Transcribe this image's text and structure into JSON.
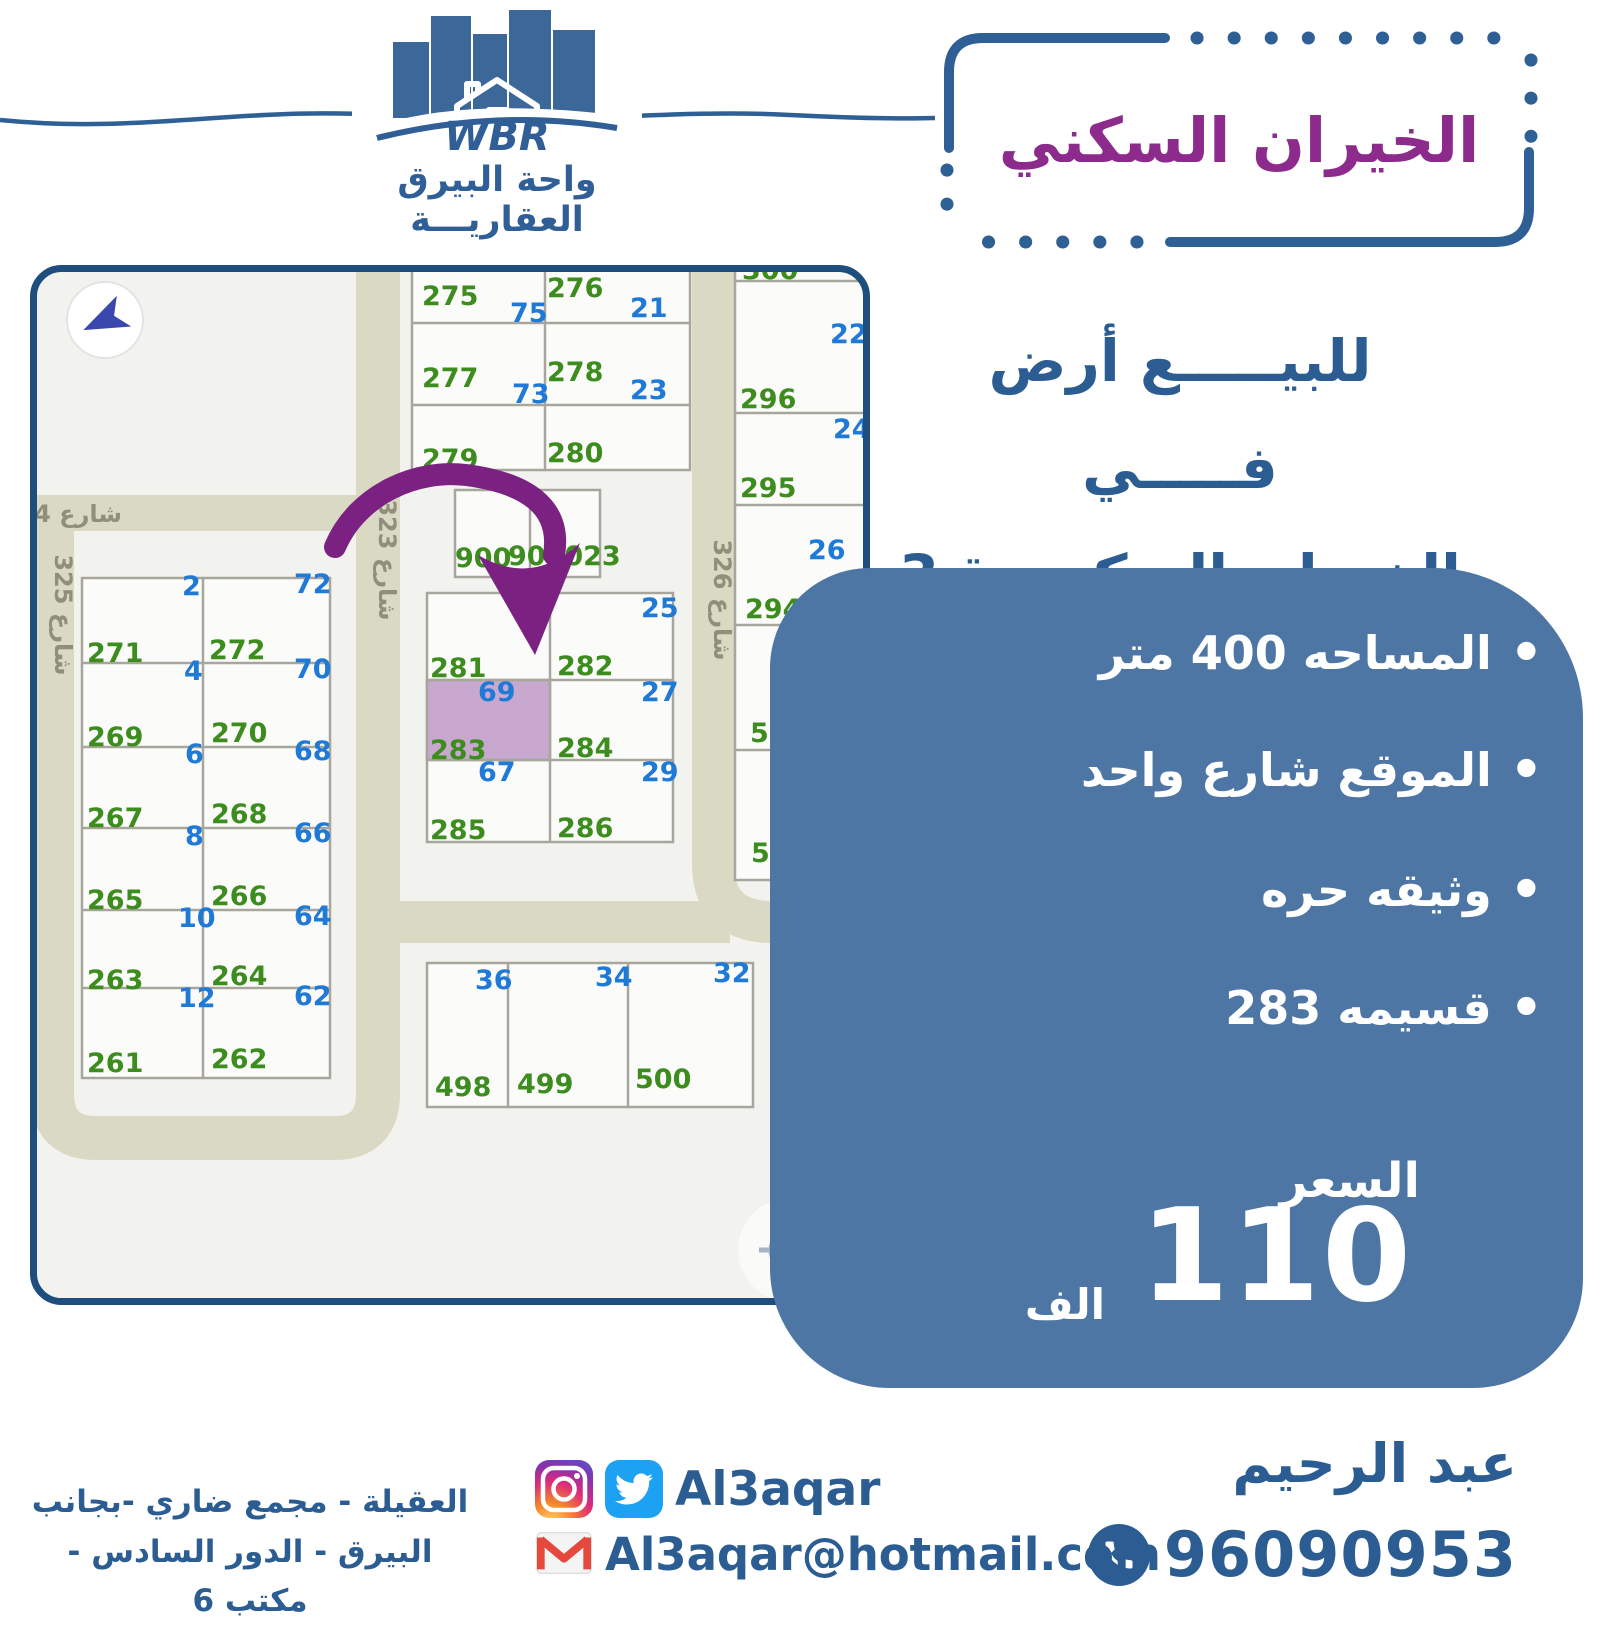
{
  "colors": {
    "accent_blue": "#2b5d93",
    "panel_blue": "#4e76a4",
    "title_purple": "#8d2b8d",
    "arrow_purple": "#7b2181",
    "plot_green": "#3d8c1e",
    "plot_blue": "#1f79d6",
    "street_fill": "#d9d9c4",
    "map_border": "#1d4e7d",
    "highlight_fill": "#c8a8ce"
  },
  "header": {
    "logo": {
      "brand": "WBR",
      "name_line1": "واحة البيرق",
      "name_line2": "العقاريـــة"
    },
    "title_box": {
      "title": "الخيران السكني"
    },
    "subtitle_line1": "للبيـــــع أرض فـــــي",
    "subtitle_line2": "الخيران السكني ق3"
  },
  "panel": {
    "bullets": [
      "المساحه 400 متر",
      "الموقع شارع واحد",
      "وثيقه حره",
      "قسيمه 283"
    ],
    "price_label": "السعر",
    "price_value": "110",
    "price_unit": "الف"
  },
  "map": {
    "highlighted_plot": "283",
    "street_labels": [
      {
        "t": "شارع 4",
        "x": 92,
        "y": 257,
        "r": 0
      },
      {
        "t": "شارع 323",
        "x": 349,
        "y": 295,
        "r": 90
      },
      {
        "t": "شارع 325",
        "x": 25,
        "y": 350,
        "r": 90
      },
      {
        "t": "شارع 326",
        "x": 684,
        "y": 335,
        "r": 90
      }
    ],
    "plot_labels": [
      {
        "t": "275",
        "c": "g",
        "x": 392,
        "y": 40
      },
      {
        "t": "276",
        "c": "g",
        "x": 517,
        "y": 32
      },
      {
        "t": "75",
        "c": "b",
        "x": 480,
        "y": 57
      },
      {
        "t": "21",
        "c": "b",
        "x": 600,
        "y": 52
      },
      {
        "t": "277",
        "c": "g",
        "x": 392,
        "y": 122
      },
      {
        "t": "278",
        "c": "g",
        "x": 517,
        "y": 116
      },
      {
        "t": "73",
        "c": "b",
        "x": 482,
        "y": 138
      },
      {
        "t": "23",
        "c": "b",
        "x": 600,
        "y": 134
      },
      {
        "t": "279",
        "c": "g",
        "x": 392,
        "y": 203
      },
      {
        "t": "280",
        "c": "g",
        "x": 517,
        "y": 197
      },
      {
        "t": "300",
        "c": "g",
        "x": 712,
        "y": 14
      },
      {
        "t": "22",
        "c": "b",
        "x": 800,
        "y": 78
      },
      {
        "t": "296",
        "c": "g",
        "x": 710,
        "y": 143
      },
      {
        "t": "24",
        "c": "b",
        "x": 803,
        "y": 173
      },
      {
        "t": "295",
        "c": "g",
        "x": 710,
        "y": 232
      },
      {
        "t": "26",
        "c": "b",
        "x": 778,
        "y": 294
      },
      {
        "t": "294",
        "c": "g",
        "x": 715,
        "y": 353
      },
      {
        "t": "28",
        "c": "b",
        "x": 806,
        "y": 377
      },
      {
        "t": "502",
        "c": "g",
        "x": 720,
        "y": 477
      },
      {
        "t": "30",
        "c": "b",
        "x": 810,
        "y": 498
      },
      {
        "t": "501",
        "c": "g",
        "x": 721,
        "y": 597
      },
      {
        "t": "900",
        "c": "g",
        "x": 425,
        "y": 302
      },
      {
        "t": "900023",
        "c": "g",
        "x": 478,
        "y": 300
      },
      {
        "t": "2",
        "c": "b",
        "x": 152,
        "y": 330
      },
      {
        "t": "72",
        "c": "b",
        "x": 264,
        "y": 328
      },
      {
        "t": "271",
        "c": "g",
        "x": 57,
        "y": 397
      },
      {
        "t": "272",
        "c": "g",
        "x": 179,
        "y": 394
      },
      {
        "t": "4",
        "c": "b",
        "x": 154,
        "y": 415
      },
      {
        "t": "70",
        "c": "b",
        "x": 264,
        "y": 413
      },
      {
        "t": "269",
        "c": "g",
        "x": 57,
        "y": 481
      },
      {
        "t": "270",
        "c": "g",
        "x": 181,
        "y": 477
      },
      {
        "t": "6",
        "c": "b",
        "x": 155,
        "y": 498
      },
      {
        "t": "68",
        "c": "b",
        "x": 264,
        "y": 495
      },
      {
        "t": "267",
        "c": "g",
        "x": 57,
        "y": 562
      },
      {
        "t": "268",
        "c": "g",
        "x": 181,
        "y": 558
      },
      {
        "t": "8",
        "c": "b",
        "x": 155,
        "y": 580
      },
      {
        "t": "66",
        "c": "b",
        "x": 264,
        "y": 577
      },
      {
        "t": "265",
        "c": "g",
        "x": 57,
        "y": 644
      },
      {
        "t": "266",
        "c": "g",
        "x": 181,
        "y": 640
      },
      {
        "t": "10",
        "c": "b",
        "x": 148,
        "y": 662
      },
      {
        "t": "64",
        "c": "b",
        "x": 264,
        "y": 660
      },
      {
        "t": "263",
        "c": "g",
        "x": 57,
        "y": 724
      },
      {
        "t": "264",
        "c": "g",
        "x": 181,
        "y": 720
      },
      {
        "t": "12",
        "c": "b",
        "x": 148,
        "y": 742
      },
      {
        "t": "62",
        "c": "b",
        "x": 264,
        "y": 740
      },
      {
        "t": "261",
        "c": "g",
        "x": 57,
        "y": 807
      },
      {
        "t": "262",
        "c": "g",
        "x": 181,
        "y": 803
      },
      {
        "t": "25",
        "c": "b",
        "x": 611,
        "y": 352
      },
      {
        "t": "281",
        "c": "g",
        "x": 400,
        "y": 412
      },
      {
        "t": "282",
        "c": "g",
        "x": 527,
        "y": 410
      },
      {
        "t": "69",
        "c": "b",
        "x": 448,
        "y": 436
      },
      {
        "t": "27",
        "c": "b",
        "x": 611,
        "y": 436
      },
      {
        "t": "283",
        "c": "g",
        "x": 400,
        "y": 494
      },
      {
        "t": "284",
        "c": "g",
        "x": 527,
        "y": 492
      },
      {
        "t": "67",
        "c": "b",
        "x": 448,
        "y": 516
      },
      {
        "t": "29",
        "c": "b",
        "x": 611,
        "y": 516
      },
      {
        "t": "285",
        "c": "g",
        "x": 400,
        "y": 574
      },
      {
        "t": "286",
        "c": "g",
        "x": 527,
        "y": 572
      },
      {
        "t": "36",
        "c": "b",
        "x": 445,
        "y": 724
      },
      {
        "t": "34",
        "c": "b",
        "x": 565,
        "y": 721
      },
      {
        "t": "32",
        "c": "b",
        "x": 683,
        "y": 717
      },
      {
        "t": "498",
        "c": "g",
        "x": 405,
        "y": 831
      },
      {
        "t": "499",
        "c": "g",
        "x": 487,
        "y": 828
      },
      {
        "t": "500",
        "c": "g",
        "x": 605,
        "y": 823
      }
    ]
  },
  "footer": {
    "agent_name": "عبد الرحيم",
    "phone": "96090953",
    "social_handle": "Al3aqar",
    "email": "Al3aqar@hotmail.com",
    "address_line1": "العقيلة - مجمع ضاري -بجانب",
    "address_line2": "البيرق - الدور السادس - مكتب 6"
  }
}
